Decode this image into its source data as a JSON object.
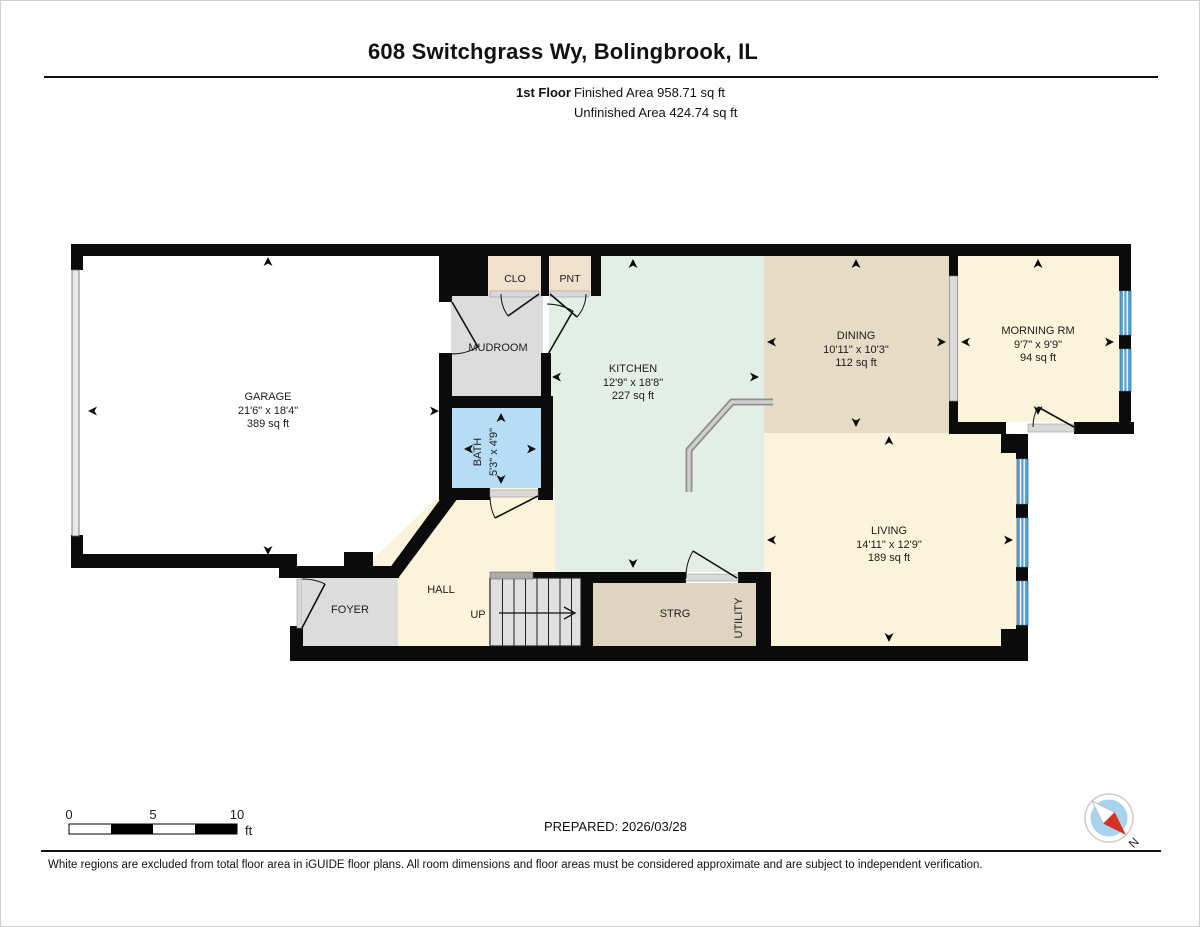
{
  "header": {
    "title": "608 Switchgrass Wy, Bolingbrook, IL",
    "floor_label": "1st Floor",
    "finished_area": "Finished Area 958.71 sq ft",
    "unfinished_area": "Unfinished Area 424.74 sq ft"
  },
  "rooms": {
    "garage": {
      "name": "GARAGE",
      "dims": "21'6\" x 18'4\"",
      "area": "389 sq ft"
    },
    "clo": {
      "name": "CLO"
    },
    "pnt": {
      "name": "PNT"
    },
    "mudroom": {
      "name": "MUDROOM"
    },
    "bath": {
      "name": "BATH",
      "dims": "5'3\" x 4'9\""
    },
    "kitchen": {
      "name": "KITCHEN",
      "dims": "12'9\" x 18'8\"",
      "area": "227 sq ft"
    },
    "dining": {
      "name": "DINING",
      "dims": "10'11\" x 10'3\"",
      "area": "112 sq ft"
    },
    "morning_rm": {
      "name": "MORNING RM",
      "dims": "9'7\" x 9'9\"",
      "area": "94 sq ft"
    },
    "living": {
      "name": "LIVING",
      "dims": "14'11\" x 12'9\"",
      "area": "189 sq ft"
    },
    "foyer": {
      "name": "FOYER"
    },
    "hall": {
      "name": "HALL"
    },
    "stairs": {
      "label": "UP"
    },
    "storage": {
      "name": "STRG"
    },
    "utility": {
      "name": "UTILITY"
    }
  },
  "scale_bar": {
    "start": "0",
    "mid": "5",
    "end": "10",
    "unit": "ft"
  },
  "prepared_label": "PREPARED: 2026/03/28",
  "compass": {
    "north_label": "N"
  },
  "footer_note": "White regions are excluded from total floor area in iGUIDE floor plans. All room dimensions and floor areas must be considered approximate and are subject to independent verification."
}
